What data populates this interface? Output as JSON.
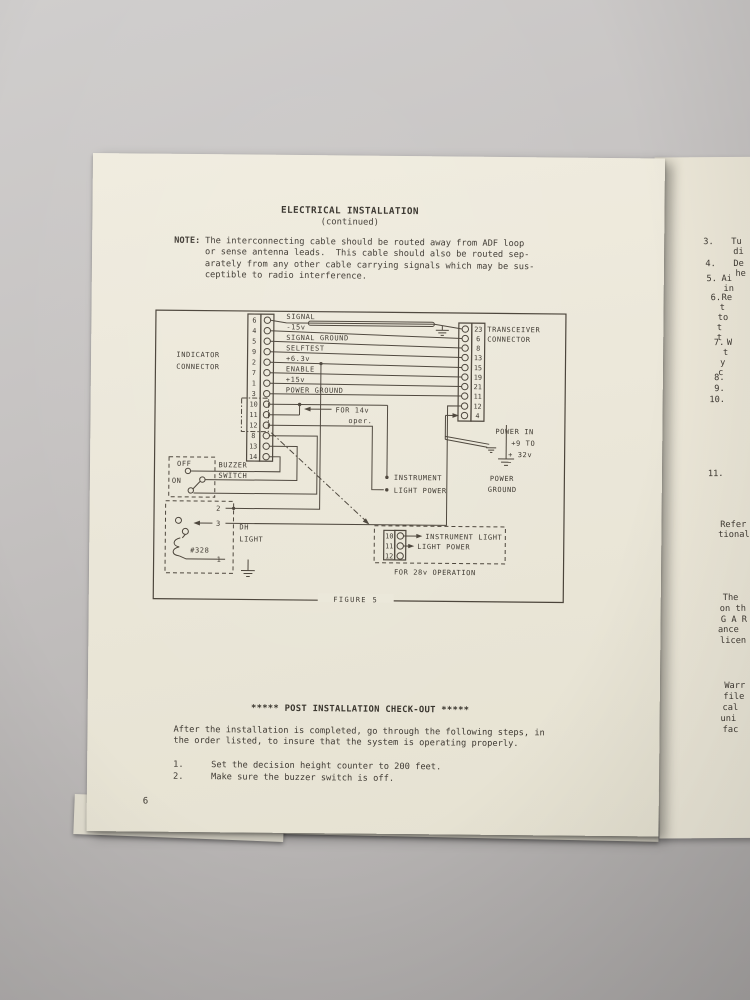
{
  "colors": {
    "paper": "#ebe7d9",
    "ink": "#3f3a33",
    "background_gray": "#bdbab9",
    "diagram_line": "#4a4339"
  },
  "page": {
    "title": "ELECTRICAL INSTALLATION",
    "subtitle": "(continued)",
    "note_label": "NOTE:",
    "note_lines": [
      "The interconnecting cable should be routed away from ADF loop",
      "or sense antenna leads.  This cable should also be routed sep-",
      "arately from any other cable carrying signals which may be sus-",
      "ceptible to radio interference."
    ],
    "figure": {
      "caption": "FIGURE 5",
      "indicator_label_1": "INDICATOR",
      "indicator_label_2": "CONNECTOR",
      "indicator_pins": [
        "6",
        "4",
        "5",
        "9",
        "2",
        "7",
        "1",
        "3",
        "10",
        "11",
        "12",
        "8",
        "13",
        "14"
      ],
      "wire_labels": [
        "SIGNAL",
        "-15v",
        "SIGNAL GROUND",
        "SELFTEST",
        "+6.3v",
        "ENABLE",
        "+15v",
        "POWER GROUND"
      ],
      "transceiver_label_1": "TRANSCEIVER",
      "transceiver_label_2": "CONNECTOR",
      "transceiver_pins": [
        "23",
        "6",
        "8",
        "13",
        "15",
        "19",
        "21",
        "11",
        "12",
        "4"
      ],
      "for_14v_1": "FOR 14v",
      "for_14v_2": "oper.",
      "instrument_1": "INSTRUMENT",
      "instrument_2": "LIGHT POWER",
      "power_in_1": "POWER IN",
      "power_in_2": "+9 TO",
      "power_in_3": "+ 32v",
      "power_ground_1": "POWER",
      "power_ground_2": "GROUND",
      "buzzer_off": "OFF",
      "buzzer_on": "ON",
      "buzzer_label_1": "BUZZER",
      "buzzer_label_2": "SWITCH",
      "dh_pin_top": "2",
      "dh_pin_mid": "3",
      "dh_pin_bot": "1",
      "dh_bulb": "#328",
      "dh_label_1": "DH",
      "dh_label_2": "LIGHT",
      "v28_pins": [
        "10",
        "11",
        "12"
      ],
      "v28_line_1": "INSTRUMENT LIGHT",
      "v28_line_2": "LIGHT POWER",
      "v28_caption": "FOR 28v OPERATION"
    },
    "checkout": {
      "heading": "***** POST INSTALLATION CHECK-OUT *****",
      "paragraph": [
        "After the installation is completed, go through the following steps, in",
        "the order listed, to insure that the system is operating properly."
      ],
      "steps": [
        {
          "num": "1.",
          "text": "Set the decision height counter to 200 feet."
        },
        {
          "num": "2.",
          "text": "Make sure the buzzer switch is off."
        }
      ]
    },
    "page_number": "6"
  },
  "right_page": {
    "fragments": [
      "3.",
      "Tu",
      "di",
      "4.",
      "De",
      "he",
      "5.",
      "Ai",
      "in",
      "6.",
      "Re",
      "t",
      "to",
      "t",
      "t",
      "7.",
      "W",
      "t",
      "y",
      "c",
      "8.",
      "9.",
      "10.",
      "11.",
      "Refer",
      "tional",
      "The",
      "on th",
      "G A R",
      "ance",
      "licen",
      "Warr",
      "file",
      "cal",
      "uni",
      "fac"
    ]
  }
}
